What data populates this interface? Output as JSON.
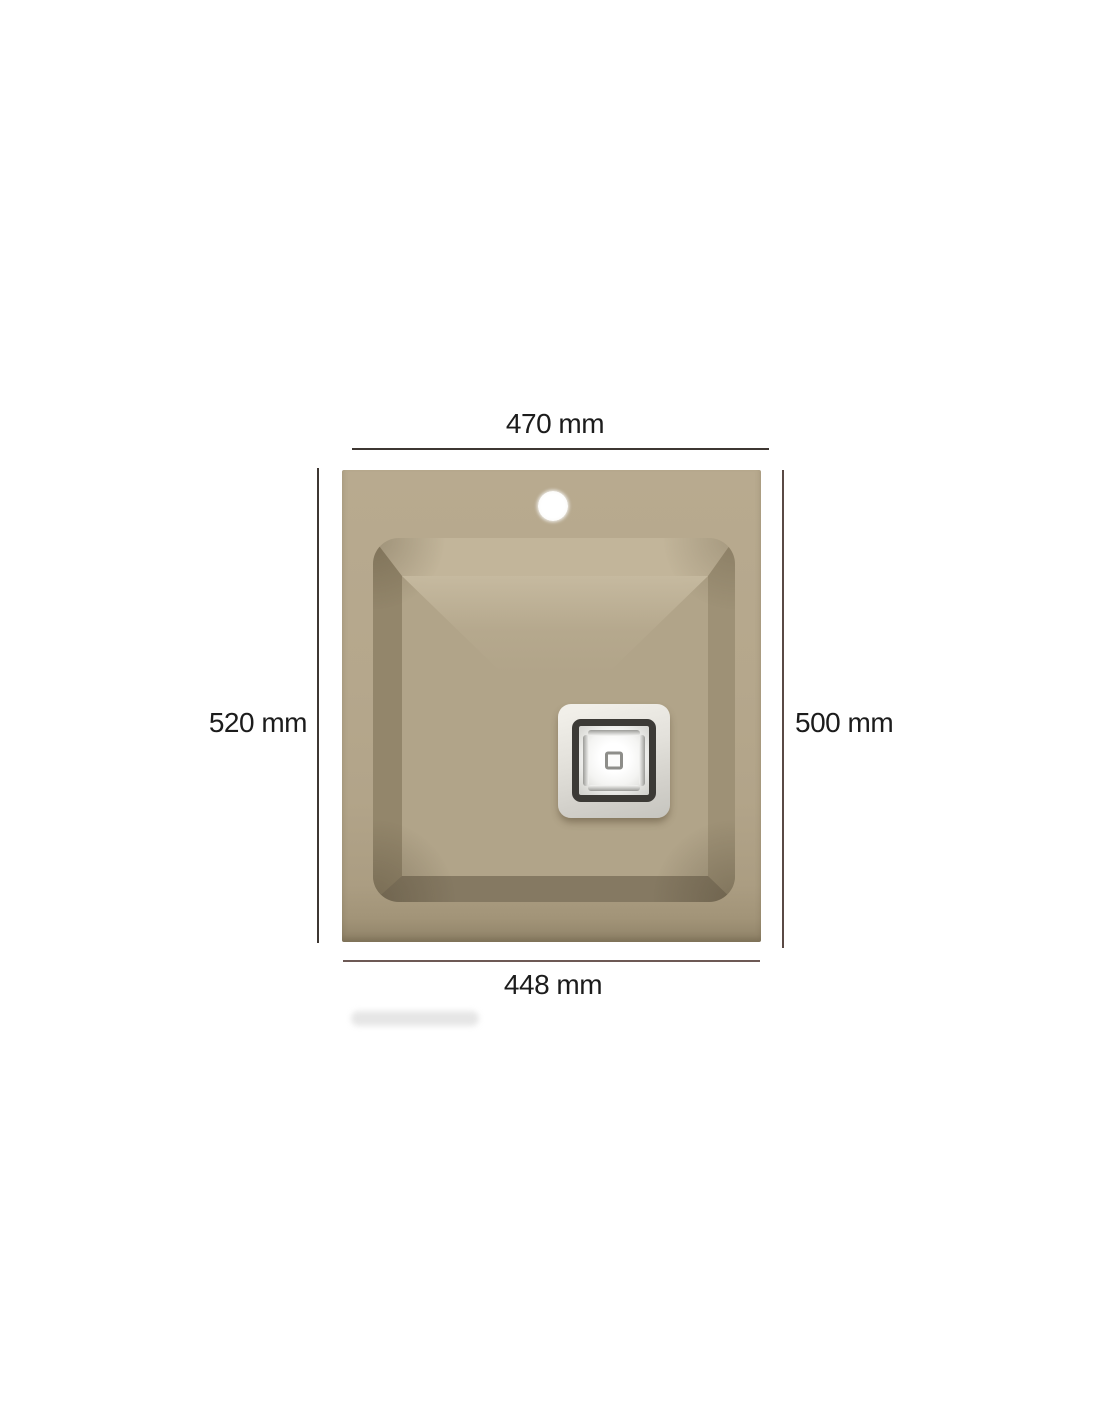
{
  "diagram": {
    "type": "product-dimension-diagram",
    "view": "kitchen-sink-top-view",
    "dimensions": {
      "top_width": "470 mm",
      "left_height": "520 mm",
      "right_height": "500 mm",
      "bottom_width": "448 mm"
    },
    "parts": [
      "faucet-hole",
      "overflow-slot",
      "basin",
      "square-drain"
    ],
    "colors": {
      "page_bg": "#ffffff",
      "text": "#1c1c1c",
      "line": "#3e3732",
      "line_right": "#5a4a45",
      "line_bottom": "#6d5955",
      "deck": "#b4a68b",
      "floor": "#b1a489",
      "bevel_top": "#c2b59a",
      "bevel_left": "#93866b",
      "bevel_right": "#9e9176",
      "bevel_bottom": "#857962",
      "drain_frame": "#e0ded9",
      "drain_ring": "#3c3a36"
    }
  }
}
